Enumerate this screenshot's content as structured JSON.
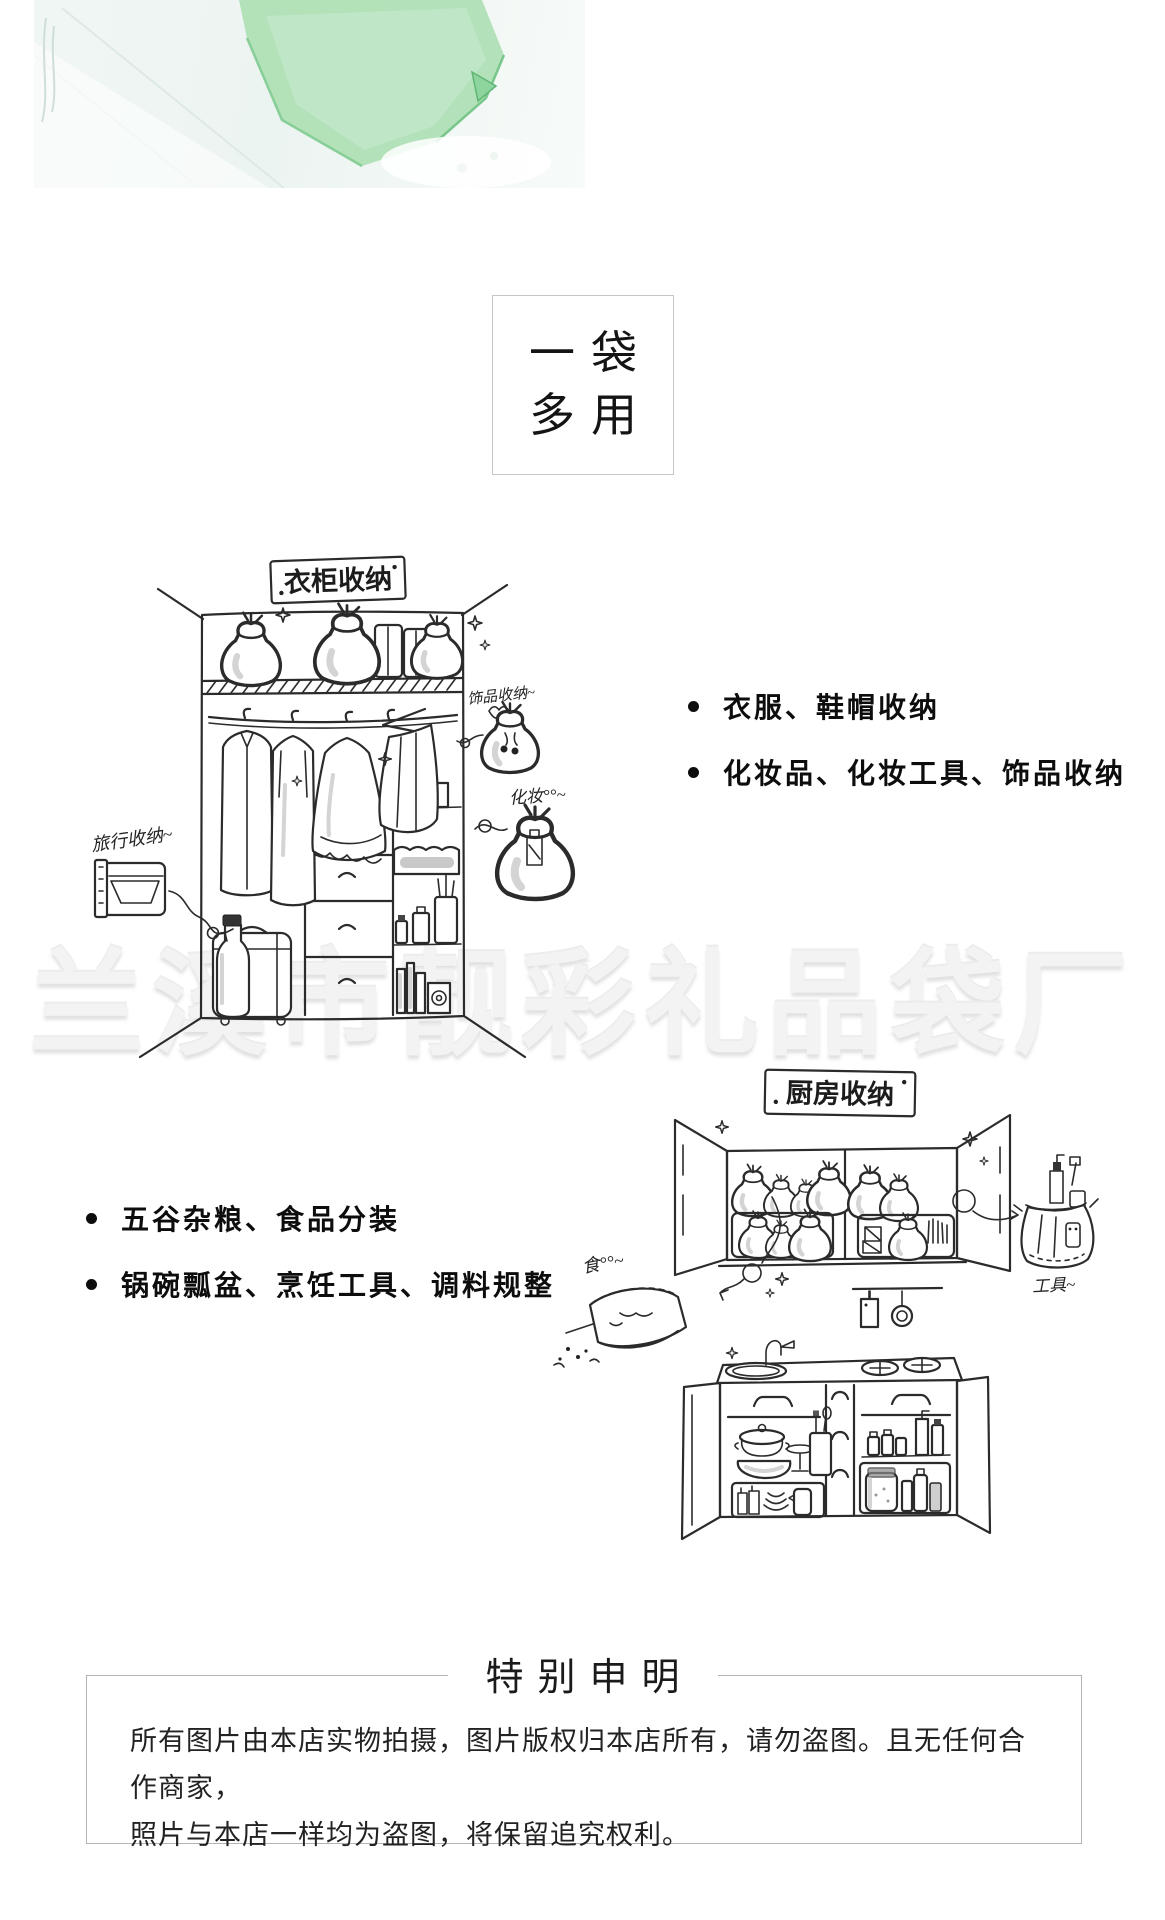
{
  "colors": {
    "bag_green": "#aedfb4",
    "bag_green_edge": "#6abf7e",
    "watermark_gray": "#f3f3f3",
    "ink": "#2b2b2b"
  },
  "badge": {
    "line1": "一袋",
    "line2": "多用"
  },
  "watermark": {
    "text": "兰溪市靓彩礼品袋厂"
  },
  "wardrobe": {
    "label": "衣柜收纳",
    "annotations": {
      "travel": "旅行收纳~",
      "accessories": "饰品收纳~",
      "makeup": "化妆°°~"
    },
    "bullets": [
      "衣服、鞋帽收纳",
      "化妆品、化妆工具、饰品收纳"
    ]
  },
  "kitchen": {
    "label": "厨房收纳",
    "annotations": {
      "food": "食°°~",
      "tools": "工具~"
    },
    "bullets": [
      "五谷杂粮、食品分装",
      "锅碗瓢盆、烹饪工具、调料规整"
    ]
  },
  "statement": {
    "title": "特别申明",
    "lines": [
      "所有图片由本店实物拍摄，图片版权归本店所有，请勿盗图。且无任何合作商家，",
      "照片与本店一样均为盗图，将保留追究权利。"
    ]
  }
}
